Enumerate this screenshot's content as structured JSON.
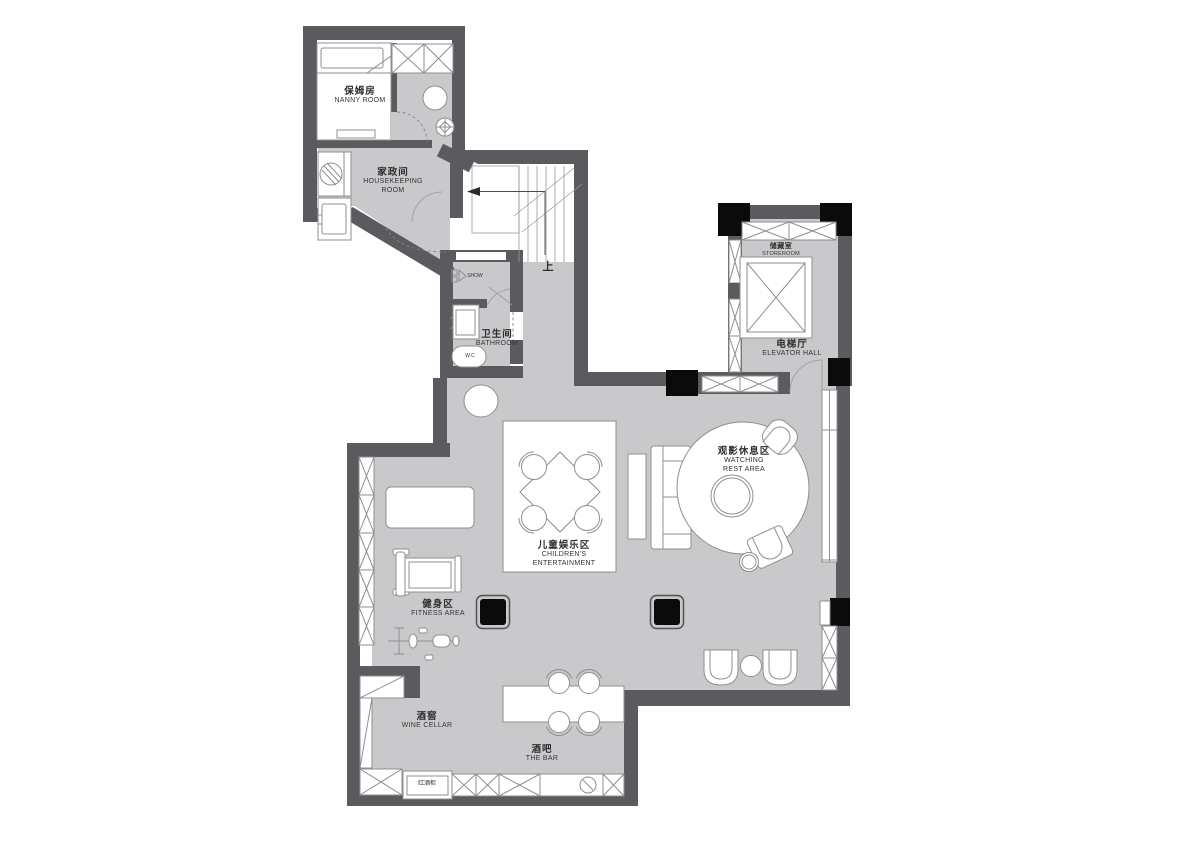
{
  "rooms": {
    "nanny": {
      "zh": "保姆房",
      "en": "NANNY ROOM"
    },
    "housekeeping": {
      "zh": "家政间",
      "en1": "HOUSEKEEPING",
      "en2": "ROOM"
    },
    "bathroom": {
      "zh": "卫生间",
      "en": "BATHROOM"
    },
    "storeroom": {
      "zh": "储藏室",
      "en": "STOREROOM"
    },
    "elevator_hall": {
      "zh": "电梯厅",
      "en": "ELEVATOR HALL"
    },
    "watching_rest": {
      "zh": "观影休息区",
      "en1": "WATCHING",
      "en2": "REST AREA"
    },
    "children": {
      "zh": "儿童娱乐区",
      "en1": "CHILDREN'S",
      "en2": "ENTERTAINMENT"
    },
    "fitness": {
      "zh": "健身区",
      "en": "FITNESS AREA"
    },
    "wine_cellar": {
      "zh": "酒窖",
      "en": "WINE CELLAR"
    },
    "bar": {
      "zh": "酒吧",
      "en": "THE BAR"
    }
  },
  "annotations": {
    "stairs_up": "上",
    "wine_fridge": "红酒柜",
    "wc": "W.C",
    "shower": "SHOW"
  },
  "colors": {
    "wall": "#5a5b5f",
    "floor": "#c9c9cb",
    "column": "#0b0b0c",
    "outline": "#8f8f92",
    "background": "#ffffff"
  }
}
